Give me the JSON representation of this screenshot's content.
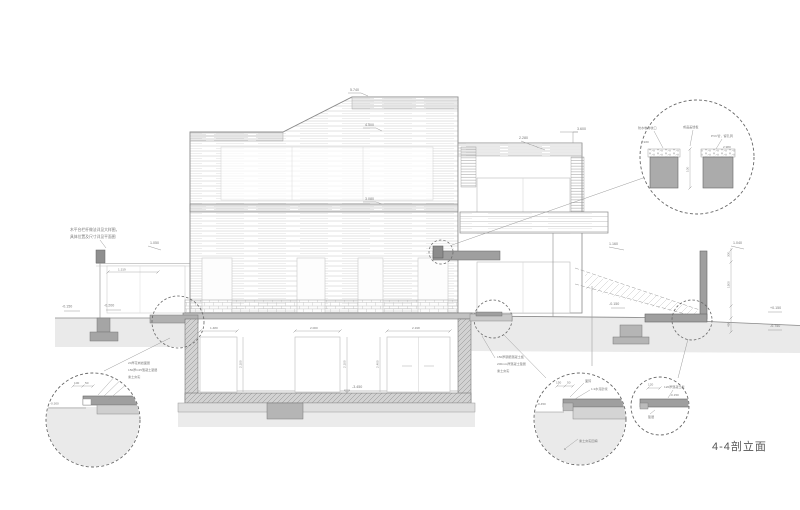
{
  "title": {
    "label": "4-4剖立面"
  },
  "levels": {
    "ridge": "5.740",
    "parapet": "4.500",
    "floor2": "3.080",
    "wing_roof": "3.600",
    "canopy": "2.280",
    "terrace_right": "1.160",
    "fence_top": "1.050",
    "ground_left_a": "-0.150",
    "ground_left_b": "-0.200",
    "basement_floor": "-3.450",
    "ground_right": "-0.150",
    "ret_wall_top": "1.040",
    "ret_right_a": "+0.150",
    "ret_right_b": "-0.750"
  },
  "notes": {
    "left_line1": "木平台栏杆做法详见大样图，",
    "left_line2": "具体位置及尺寸详见平面图",
    "slab_line1": "150厚钢筋混凝土板",
    "slab_line2": "200mm厚混凝土垫层",
    "slab_line3": "素土夯实"
  },
  "dims": {
    "gate_width": "1.319",
    "door1_width": "1.480",
    "door2_width": "2.000",
    "door3_width": "2.198",
    "door1_height": "2.100",
    "door2_height": "2.100",
    "door3_height": "2.400",
    "ret_a": "300",
    "ret_b": "1500",
    "ret_c": "450",
    "joint_gap": "100"
  },
  "details": {
    "a": {
      "label1": "防水卷材收口",
      "label2": "成品盖缝板",
      "label3": "PVC管，留孔洞",
      "level_left": "2.930",
      "level_right": "2.980"
    },
    "b": {
      "label1": "20厚花岗岩面层",
      "label2": "150厚C25混凝土垫层",
      "label3": "素土夯实",
      "level": "-0.300",
      "dim_a": "100",
      "dim_b": "50"
    },
    "c": {
      "label1": "面砖",
      "label2": "1:2水泥砂浆",
      "label3": "素土夯实回填",
      "level": "-0.450",
      "dim_a": "150",
      "dim_b": "50"
    },
    "d": {
      "label1": "120厚混凝土板",
      "label2": "垫层",
      "level": "-0.150",
      "dim_a": "120"
    }
  }
}
